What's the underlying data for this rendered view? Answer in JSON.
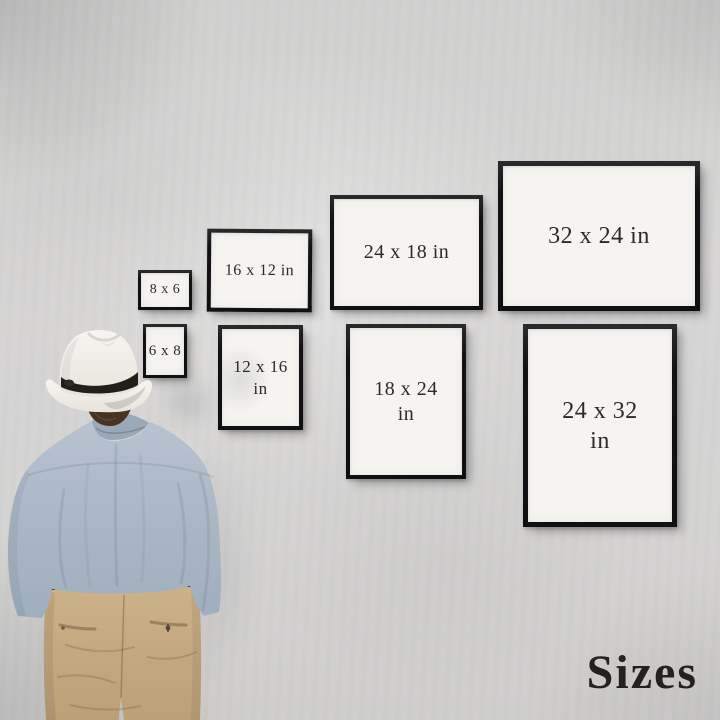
{
  "caption": {
    "text": "Sizes"
  },
  "frames": [
    {
      "label": "8 x 6",
      "orientation": "landscape"
    },
    {
      "label": "16 x 12 in",
      "orientation": "landscape"
    },
    {
      "label": "24 x 18 in",
      "orientation": "landscape"
    },
    {
      "label": "32 x 24 in",
      "orientation": "landscape"
    },
    {
      "label": "6 x 8",
      "orientation": "portrait"
    },
    {
      "label": "12 x 16",
      "unit": "in",
      "orientation": "portrait"
    },
    {
      "label": "18 x 24",
      "unit": "in",
      "orientation": "portrait"
    },
    {
      "label": "24 x 32",
      "unit": "in",
      "orientation": "portrait"
    }
  ],
  "colors": {
    "wall": "#d4d3d2",
    "frame_border": "#121214",
    "frame_face": "#f5f4f1",
    "label_text": "#2b2a28",
    "caption_text": "#232220",
    "hat": "#f2f0ec",
    "hat_band": "#221e1a",
    "hair": "#483220",
    "shirt": "#a9b6c4",
    "pants": "#c8ad85"
  }
}
